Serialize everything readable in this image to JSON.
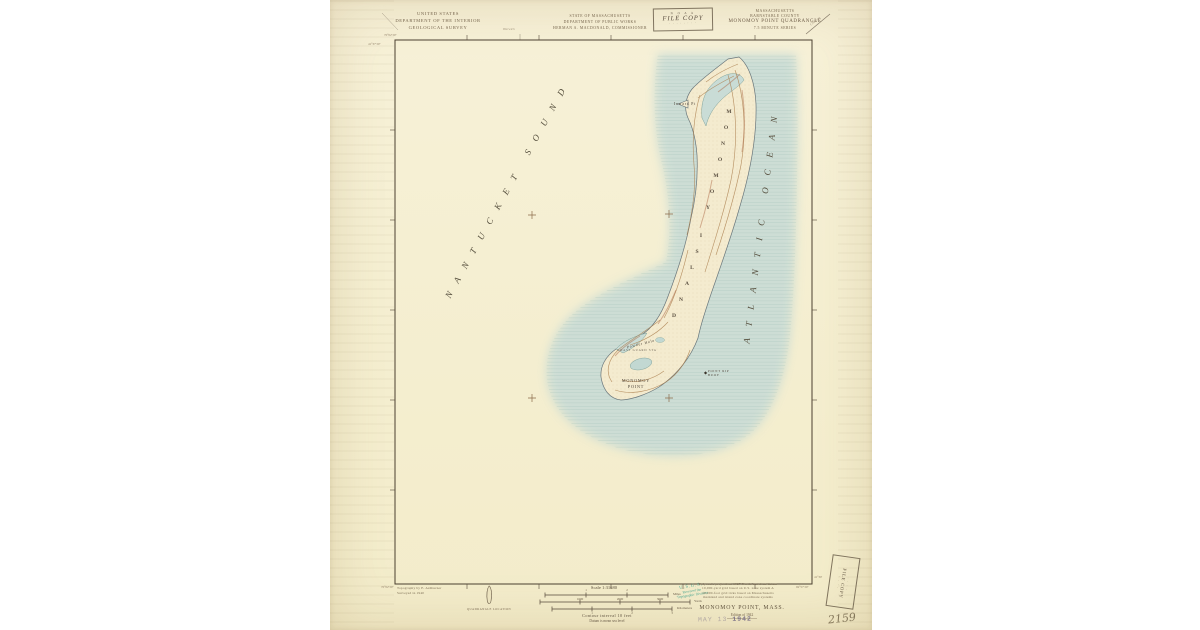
{
  "header": {
    "agency": [
      "UNITED STATES",
      "DEPARTMENT OF THE INTERIOR",
      "GEOLOGICAL SURVEY"
    ],
    "state": [
      "STATE OF MASSACHUSETTS",
      "DEPARTMENT OF PUBLIC WORKS",
      "HERMAN A. MACDONALD, COMMISSIONER"
    ],
    "quad": [
      "MASSACHUSETTS",
      "BARNSTABLE COUNTY",
      "MONOMOY POINT QUADRANGLE",
      "7.5 MINUTE SERIES"
    ],
    "file_stamp": {
      "top": "N O A A",
      "main": "FILE COPY",
      "bottom": "· · · · · · · ·"
    },
    "road_left": "Harwich",
    "road_right": "Chatham"
  },
  "map": {
    "sound_label": "NANTUCKET SOUND",
    "ocean_label": "ATLANTIC OCEAN",
    "island_label": "MONOMOY ISLAND",
    "inward_pt": "Inward Pt",
    "powder_hole": "Powder Hole",
    "coast_guard": "COAST GUARD STA",
    "monomoy_point_line1": "MONOMOY",
    "monomoy_point_line2": "POINT",
    "point_rip_line1": "POINT RIP",
    "point_rip_line2": "BUOY",
    "colors": {
      "water": "#c9dcd6",
      "land": "#f4ebcf",
      "contour": "#ab7f4e",
      "accent": "#a85f3c"
    }
  },
  "corners": {
    "tl_lon": "70°02'30\"",
    "tl_lat": "41°37'30\"",
    "bl_lon": "70°02'30\"",
    "br_lon": "69°57'30\"",
    "br_lat": "41°30'"
  },
  "footer": {
    "credit_line1": "Topography by E. Ashburner",
    "credit_line2": "Surveyed in 1940",
    "quad_location_caption": "QUADRANGLE LOCATION",
    "scale_text": "Scale 1:31680",
    "miles_ticks": [
      "1",
      "2"
    ],
    "miles_label": "Miles",
    "yards_ticks": [
      "1000",
      "2000",
      "3000"
    ],
    "yards_label": "Yards",
    "km_ticks": [
      "1",
      "2",
      "3"
    ],
    "km_label": "Kilometers",
    "contour_note": "Contour interval 10 feet",
    "datum_note": "Datum is mean sea level",
    "projection_notes": [
      "Polyconic projection. 1927 North American datum",
      "10,000-yard grid based on U.S. zone system A",
      "10,000-foot grid ticks based on Massachusetts",
      "mainland and island zone coordinate systems"
    ],
    "received_stamp": [
      "U.S.G.S.",
      "Received the",
      "Topographic Division"
    ],
    "title": "MONOMOY POINT, MASS.",
    "edition": "Edition of 1942",
    "date_stamp_faint": "MAY 13",
    "date_stamp_bold": "1942",
    "sheet_number": "2159",
    "library_stamp": "FILE COPY",
    "library_stamp_dots": "· · · ·"
  }
}
